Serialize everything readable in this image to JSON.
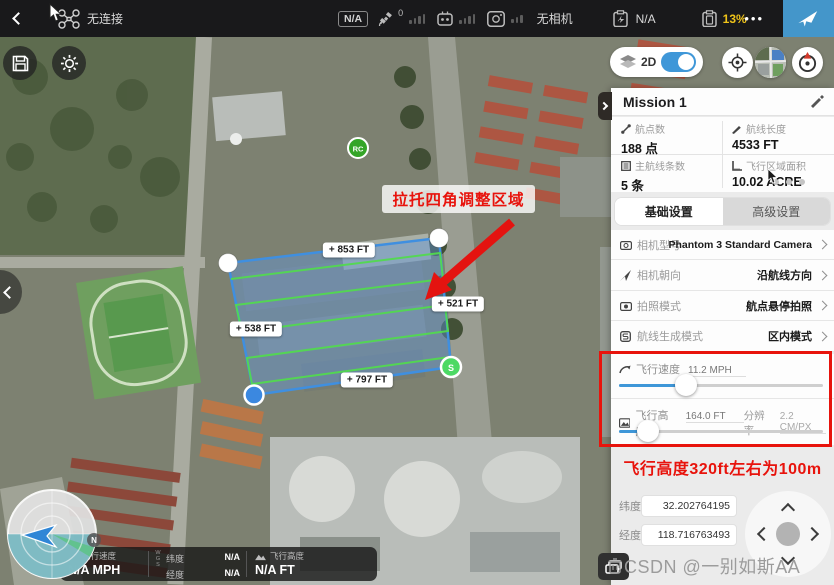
{
  "topbar": {
    "connection_status": "无连接",
    "gps_badge": "N/A",
    "satellite_count": "0",
    "camera_status": "无相机",
    "aircraft_battery": "N/A",
    "device_battery": "13%",
    "more_label": "•••"
  },
  "map_controls": {
    "view_mode": "2D"
  },
  "map": {
    "region_hint": "拉托四角调整区域",
    "distances": [
      "+ 853 FT",
      "+ 521 FT",
      "+ 538 FT",
      "+ 797 FT"
    ],
    "start_marker": "S",
    "rc_marker": "RC",
    "compass_north": "N"
  },
  "panel": {
    "title": "Mission 1",
    "stats": [
      {
        "label": "航点数",
        "value": "188 点"
      },
      {
        "label": "航线长度",
        "value": "4533 FT"
      },
      {
        "label": "主航线条数",
        "value": "5 条"
      },
      {
        "label": "飞行区域面积",
        "value": "10.02 ACRE"
      }
    ],
    "tabs": [
      {
        "label": "基础设置"
      },
      {
        "label": "高级设置"
      }
    ],
    "settings": [
      {
        "label": "相机型号",
        "value": "Phantom 3 Standard Camera"
      },
      {
        "label": "相机朝向",
        "value": "沿航线方向"
      },
      {
        "label": "拍照模式",
        "value": "航点悬停拍照"
      },
      {
        "label": "航线生成模式",
        "value": "区内模式"
      }
    ],
    "speed": {
      "label": "飞行速度",
      "value": "11.2 MPH"
    },
    "altitude": {
      "label": "飞行高度",
      "value": "164.0 FT",
      "res_label": "分辨率",
      "res_value": "2.2 CM/PX"
    },
    "note": "飞行高度320ft左右为100m",
    "coords": [
      {
        "label": "纬度",
        "value": "32.202764195"
      },
      {
        "label": "经度",
        "value": "118.716763493"
      }
    ]
  },
  "statusbar": {
    "speed_label": "飞行速度",
    "speed_value": "N/A MPH",
    "datum": "WGS",
    "lat_label": "纬度",
    "lat_value": "N/A",
    "lng_label": "经度",
    "lng_value": "N/A",
    "alt_label": "飞行高度",
    "alt_value": "N/A FT"
  },
  "watermark": "CSDN @一别如斯AA",
  "colors": {
    "accent_blue": "#3E97D8",
    "battery_yellow": "#F0C419",
    "alert_red": "#E8130C",
    "polygon_blue": "#3F8FE0",
    "path_green": "#52D94F",
    "start_green": "#4CD964"
  }
}
